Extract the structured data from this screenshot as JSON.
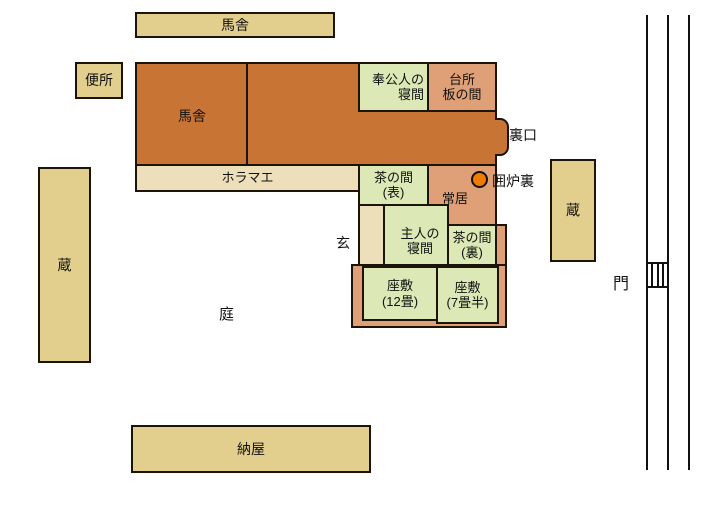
{
  "colors": {
    "outbuilding_khaki": "#e2cf8d",
    "passage_pale_tan": "#ecdfba",
    "stable_orange": "#c87434",
    "tatami_green": "#dce8b5",
    "earth_salmon": "#dfa077",
    "hearth_orange": "#ef7c00",
    "outline_black": "#1c1408"
  },
  "buildings": {
    "stable_annex": "馬舎",
    "toilet": "便所",
    "storehouse_left": "蔵",
    "storehouse_right": "蔵",
    "barn": "納屋"
  },
  "house": {
    "stable": "馬舎",
    "servants_room": [
      "奉公人の",
      "寝間"
    ],
    "kitchen": [
      "台所",
      "板の間"
    ],
    "horamae": "ホラマエ",
    "tea_room_front": [
      "茶の間",
      "(表)"
    ],
    "living_room": "常居",
    "master_bedroom": [
      "主人の",
      "寝間"
    ],
    "tea_room_back": [
      "茶の間",
      "(裏)"
    ],
    "zashiki_12": [
      "座敷",
      "(12畳)"
    ],
    "zashiki_7half": [
      "座敷",
      "(7畳半)"
    ]
  },
  "annotations": {
    "back_door": "裏口",
    "hearth": "囲炉裏",
    "entrance": "玄",
    "garden": "庭",
    "gate": "門"
  }
}
